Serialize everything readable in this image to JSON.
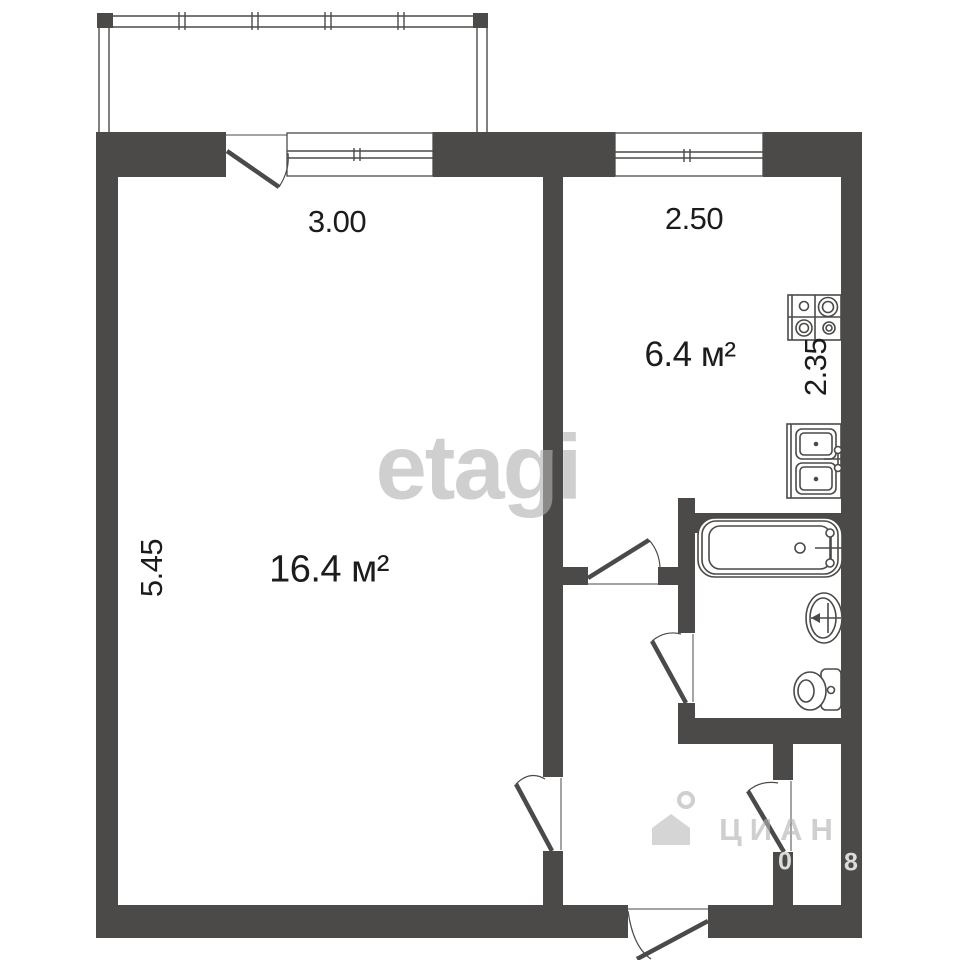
{
  "meta": {
    "type": "apartment floor plan"
  },
  "labels": {
    "room_area": "16.4 м²",
    "room_width": "3.00",
    "room_height": "5.45",
    "kitchen_area": "6.4 м²",
    "kitchen_width": "2.50",
    "kitchen_height": "2.35"
  },
  "watermarks": {
    "brand": "etagi",
    "portal": "ЦИАН",
    "digit_left": "0",
    "digit_right": "8"
  },
  "colors": {
    "background": "#ffffff",
    "wall": "#4b4a48",
    "label": "#1c1c1c"
  }
}
